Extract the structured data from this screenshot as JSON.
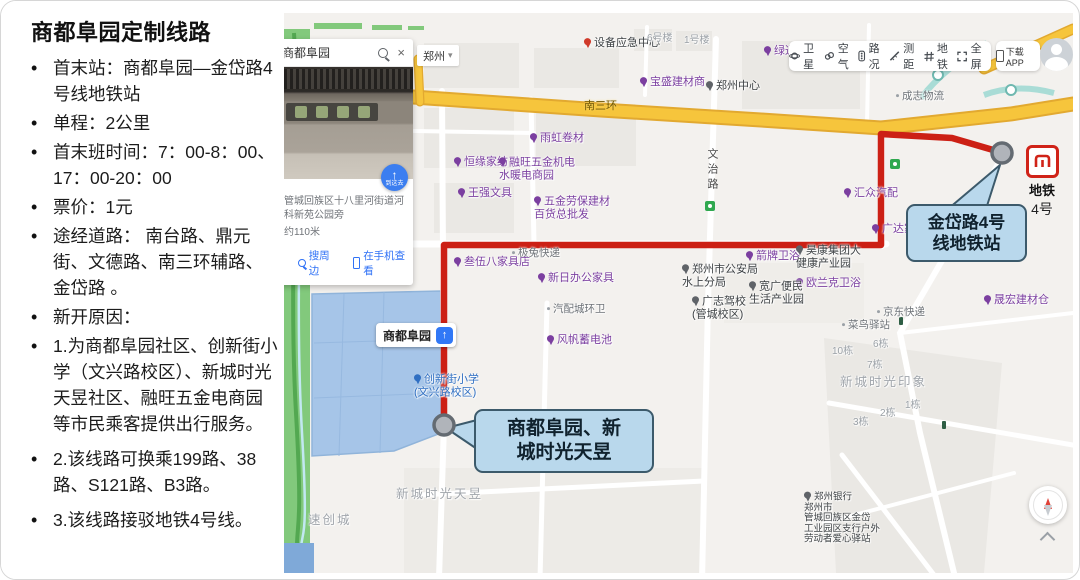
{
  "sidebar": {
    "title": "商都阜园定制线路",
    "bullets": [
      {
        "text": "首末站：商都阜园—金岱路4号线地铁站"
      },
      {
        "text": "单程：2公里"
      },
      {
        "text": "首末班时间：7：00-8：00、17：00-20：00"
      },
      {
        "text": "票价：1元"
      },
      {
        "text": "途经道路： 南台路、鼎元街、文德路、南三环辅路、金岱路 。"
      },
      {
        "text": "新开原因："
      },
      {
        "text": "1.为商都阜园社区、创新街小学（文兴路校区）、新城时光天昱社区、融旺五金电商园等市民乘客提供出行服务。"
      },
      {
        "text": "2.该线路可换乘199路、38路、S121路、B3路。",
        "gap": true
      },
      {
        "text": "3.该线路接驳地铁4号线。",
        "gap": true
      }
    ]
  },
  "map": {
    "panel": {
      "search_value": "商都阜园",
      "city": "郑州",
      "city_caret": "▾",
      "photo_button_arrow": "↑",
      "photo_button": "到这去",
      "address_line1": "管城回族区十八里河街道河科新苑公园旁",
      "address_line2": "约110米",
      "link_nearby": "搜周边",
      "link_mobile": "在手机查看",
      "claim": "免费认领本店",
      "share": "分享",
      "send_car": "发送到汽车",
      "correct": "纠错"
    },
    "toolbar": {
      "items": [
        {
          "label": "卫星",
          "icon": "satellite-icon"
        },
        {
          "label": "空气",
          "icon": "air-icon"
        },
        {
          "label": "路况",
          "icon": "traffic-icon"
        },
        {
          "label": "测距",
          "icon": "ruler-icon"
        },
        {
          "label": "地铁",
          "icon": "metro-icon"
        },
        {
          "label": "全屏",
          "icon": "fullscreen-icon"
        }
      ],
      "download": "下载APP"
    },
    "callout_end": {
      "line1": "金岱路4号",
      "line2": "线地铁站"
    },
    "callout_start": {
      "line1": "商都阜园、新",
      "line2": "城时光天昱"
    },
    "metro_badge": {
      "title": "地铁",
      "line": "4号"
    },
    "chip_label": "商都阜园",
    "road_labels": [
      {
        "text": "南三环",
        "x": 300,
        "y": 84,
        "dir": "h"
      },
      {
        "text": "文治路",
        "x": 420,
        "y": 135,
        "dir": "v"
      }
    ],
    "pois": [
      {
        "t": "雨虹卷材",
        "x": 246,
        "y": 126,
        "c": "p"
      },
      {
        "t": "恒缘家纺",
        "x": 170,
        "y": 150,
        "c": "p"
      },
      {
        "t": "融旺五金机电\n水暖电商园",
        "x": 215,
        "y": 157,
        "c": "p"
      },
      {
        "t": "王强文具",
        "x": 174,
        "y": 181,
        "c": "p"
      },
      {
        "t": "五金劳保建材\n百货总批发",
        "x": 250,
        "y": 196,
        "c": "p"
      },
      {
        "t": "极兔快递",
        "x": 228,
        "y": 241,
        "c": "g"
      },
      {
        "t": "叁伍八家具店",
        "x": 170,
        "y": 250,
        "c": "p"
      },
      {
        "t": "新日办公家具",
        "x": 254,
        "y": 266,
        "c": "p"
      },
      {
        "t": "郑州市公安局\n水上分局",
        "x": 398,
        "y": 264,
        "c": "d"
      },
      {
        "t": "汇众汽配",
        "x": 560,
        "y": 181,
        "c": "p"
      },
      {
        "t": "广达家具城",
        "x": 588,
        "y": 217,
        "c": "p"
      },
      {
        "t": "箭牌卫浴",
        "x": 462,
        "y": 244,
        "c": "p"
      },
      {
        "t": "昊康集团大\n健康产业园",
        "x": 512,
        "y": 245,
        "c": "d"
      },
      {
        "t": "欧兰克卫浴",
        "x": 512,
        "y": 271,
        "c": "p"
      },
      {
        "t": "宽广便民\n生活产业园",
        "x": 465,
        "y": 281,
        "c": "d"
      },
      {
        "t": "广志驾校\n(管城校区)",
        "x": 408,
        "y": 296,
        "c": "d"
      },
      {
        "t": "晟宏建材仓",
        "x": 700,
        "y": 288,
        "c": "p"
      },
      {
        "t": "京东快递",
        "x": 593,
        "y": 300,
        "c": "g"
      },
      {
        "t": "菜鸟驿站",
        "x": 558,
        "y": 313,
        "c": "g"
      },
      {
        "t": "汽配城环卫",
        "x": 263,
        "y": 297,
        "c": "g"
      },
      {
        "t": "风帆蓄电池",
        "x": 263,
        "y": 328,
        "c": "p"
      },
      {
        "t": "创新街小学\n(文兴路校区)",
        "x": 130,
        "y": 374,
        "c": "b"
      },
      {
        "t": "新城时光天昱",
        "x": 112,
        "y": 482,
        "c": "a"
      },
      {
        "t": "速创城",
        "x": 24,
        "y": 508,
        "c": "a"
      },
      {
        "t": "新城时光印象",
        "x": 556,
        "y": 370,
        "c": "a"
      },
      {
        "t": "6栋",
        "x": 589,
        "y": 333,
        "c": "n"
      },
      {
        "t": "10栋",
        "x": 548,
        "y": 340,
        "c": "n"
      },
      {
        "t": "7栋",
        "x": 583,
        "y": 354,
        "c": "n"
      },
      {
        "t": "1栋",
        "x": 621,
        "y": 394,
        "c": "n"
      },
      {
        "t": "2栋",
        "x": 596,
        "y": 402,
        "c": "n"
      },
      {
        "t": "3栋",
        "x": 569,
        "y": 411,
        "c": "n"
      },
      {
        "t": "成志物流",
        "x": 612,
        "y": 84,
        "c": "g"
      },
      {
        "t": "设备应急中心",
        "x": 300,
        "y": 31,
        "c": "r"
      },
      {
        "t": "6号楼",
        "x": 363,
        "y": 27,
        "c": "n"
      },
      {
        "t": "1号楼",
        "x": 400,
        "y": 29,
        "c": "n"
      },
      {
        "t": "绿通电",
        "x": 480,
        "y": 39,
        "c": "p"
      },
      {
        "t": "宝盛建材商",
        "x": 356,
        "y": 70,
        "c": "p"
      },
      {
        "t": "郑州中心",
        "x": 422,
        "y": 74,
        "c": "d"
      },
      {
        "t": "郑州银行\n郑州市\n管城回族区金岱\n工业园区支行户外\n劳动者爱心驿站",
        "x": 520,
        "y": 508,
        "c": "d",
        "s": true
      }
    ],
    "colors": {
      "route": "#cc2015",
      "callout_fill": "#b9d8ec",
      "callout_border": "#3c5a6b",
      "yellow_road": "#f6c53c",
      "poi_purple": "#7b3fa0",
      "metro_red": "#d02318"
    }
  }
}
